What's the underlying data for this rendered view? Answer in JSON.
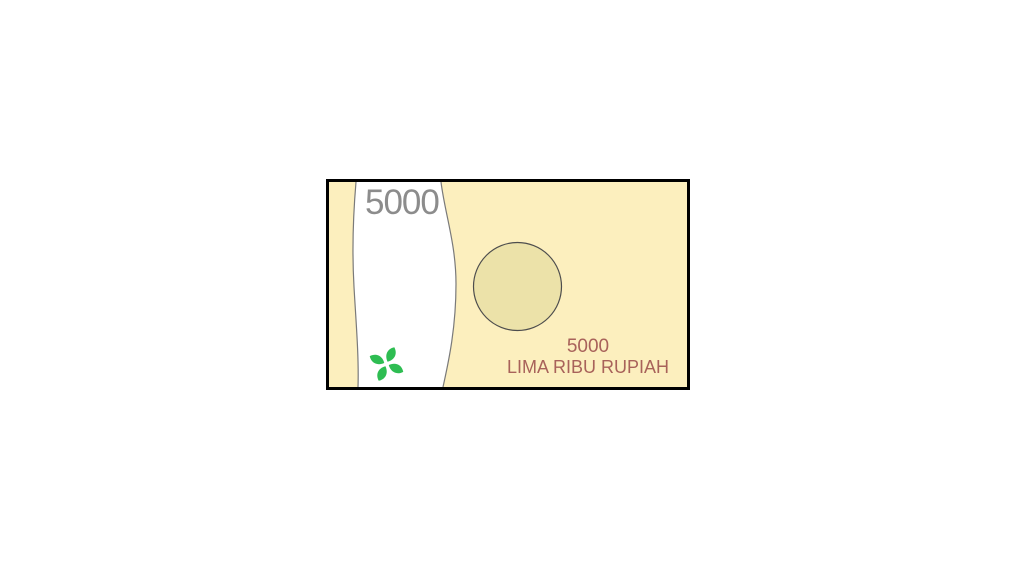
{
  "banknote": {
    "corner_value": "5000",
    "denomination": {
      "value": "5000",
      "text": "LIMA RIBU RUPIAH"
    },
    "icons": [
      {
        "name": "leaf-flower-icon",
        "shape": "four-leaf pinwheel"
      },
      {
        "name": "watermark-circle",
        "shape": "circle"
      },
      {
        "name": "security-band",
        "shape": "vertical wavy white band"
      }
    ],
    "colors": {
      "paper": "#FCEFBE",
      "watermark_circle": "#ECE2A9",
      "security_band": "#FFFFFF",
      "band_edge": "#7A7A7A",
      "border": "#000000",
      "corner_value_text": "#8C8C8C",
      "denomination_text": "#A8625A",
      "leaf_green": "#2EBD52"
    }
  }
}
